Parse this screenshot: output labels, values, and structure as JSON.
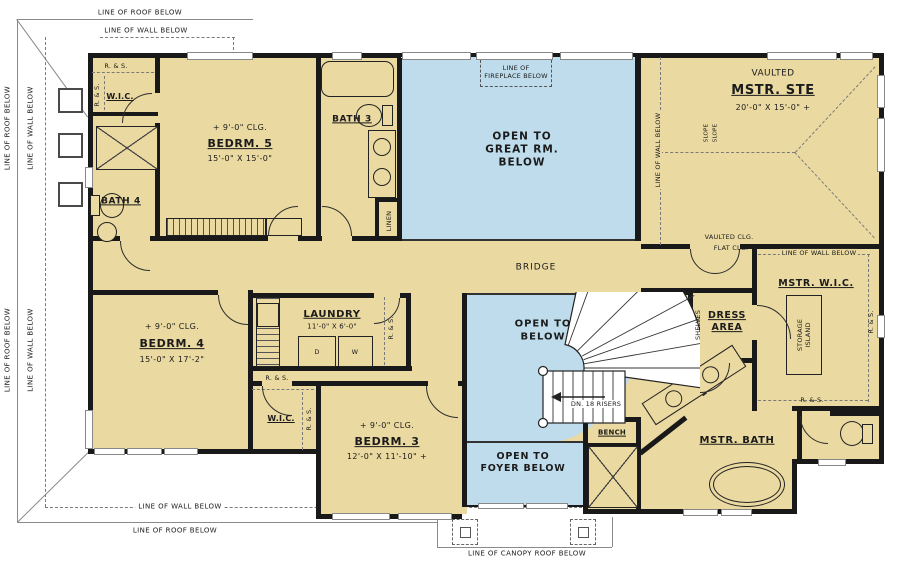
{
  "colors": {
    "room_fill": "#ead9a0",
    "open_fill": "#bedceb",
    "wall": "#191919"
  },
  "perimeter": {
    "roof_below": "LINE OF ROOF BELOW",
    "wall_below": "LINE OF WALL BELOW",
    "canopy": "LINE OF CANOPY ROOF BELOW",
    "fireplace": "LINE OF\nFIREPLACE BELOW"
  },
  "rooms": {
    "bedroom5": {
      "ceiling": "+ 9'-0\" CLG.",
      "name": "BEDRM. 5",
      "dims": "15'-0\" X 15'-0\""
    },
    "bedroom4": {
      "ceiling": "+ 9'-0\" CLG.",
      "name": "BEDRM. 4",
      "dims": "15'-0\" X 17'-2\""
    },
    "bedroom3": {
      "ceiling": "+ 9'-0\" CLG.",
      "name": "BEDRM. 3",
      "dims": "12'-0\" X 11'-10\" +"
    },
    "master_suite": {
      "tag": "VAULTED",
      "name": "MSTR. STE",
      "dims": "20'-0\" X 15'-0\" +"
    },
    "master_bath": {
      "name": "MSTR. BATH"
    },
    "master_wic": {
      "name": "MSTR. W.I.C."
    },
    "bath3": {
      "name": "BATH 3"
    },
    "bath4": {
      "name": "BATH 4"
    },
    "wic_bed5": {
      "name": "W.I.C."
    },
    "wic_bed3": {
      "name": "W.I.C."
    },
    "laundry": {
      "name": "LAUNDRY",
      "dims": "11'-0\" X 6'-0\""
    },
    "bridge": {
      "name": "BRIDGE"
    },
    "dress": {
      "name": "DRESS\nAREA"
    }
  },
  "open_areas": {
    "great_room": "OPEN TO\nGREAT RM.\nBELOW",
    "below": "OPEN TO\nBELOW",
    "foyer": "OPEN TO\nFOYER BELOW"
  },
  "annotations": {
    "rs": "R. & S.",
    "linen": "LINEN",
    "shelves": "SHELVES",
    "bench": "BENCH",
    "slope": "SLOPE",
    "vaulted_clg": "VAULTED CLG.",
    "flat_clg": "FLAT CLG.",
    "dn": "DN. 18 RISERS",
    "storage_island": "STORAGE\nISLAND",
    "washer": "W",
    "dryer": "D"
  }
}
